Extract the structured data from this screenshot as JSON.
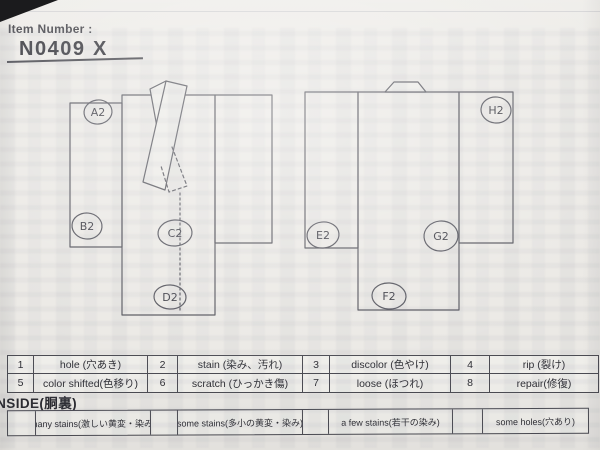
{
  "header": {
    "label": "Item Number :",
    "number": "N0409",
    "suffix": "X"
  },
  "markers": {
    "front": [
      "A2",
      "B2",
      "C2",
      "D2"
    ],
    "back": [
      "E2",
      "F2",
      "G2",
      "H2"
    ]
  },
  "defect_table": {
    "rows": [
      [
        {
          "num": "1",
          "label": "hole (穴あき)"
        },
        {
          "num": "2",
          "label": "stain (染み、汚れ)"
        },
        {
          "num": "3",
          "label": "discolor (色やけ)"
        },
        {
          "num": "4",
          "label": "rip (裂け)"
        }
      ],
      [
        {
          "num": "5",
          "label": "color shifted(色移り)"
        },
        {
          "num": "6",
          "label": "scratch (ひっかき傷)"
        },
        {
          "num": "7",
          "label": "loose (ほつれ)"
        },
        {
          "num": "8",
          "label": "repair(修復)"
        }
      ]
    ]
  },
  "inside": {
    "title": "INSIDE(胴裏)",
    "options": [
      "many stains(激しい黄変・染み)",
      "some stains(多小の黄変・染み)",
      "a few stains(若干の染み)",
      "some holes(穴あり)"
    ]
  },
  "colors": {
    "paper": "#ebe9e5",
    "ink": "#55555c",
    "text": "#2e2e34"
  }
}
